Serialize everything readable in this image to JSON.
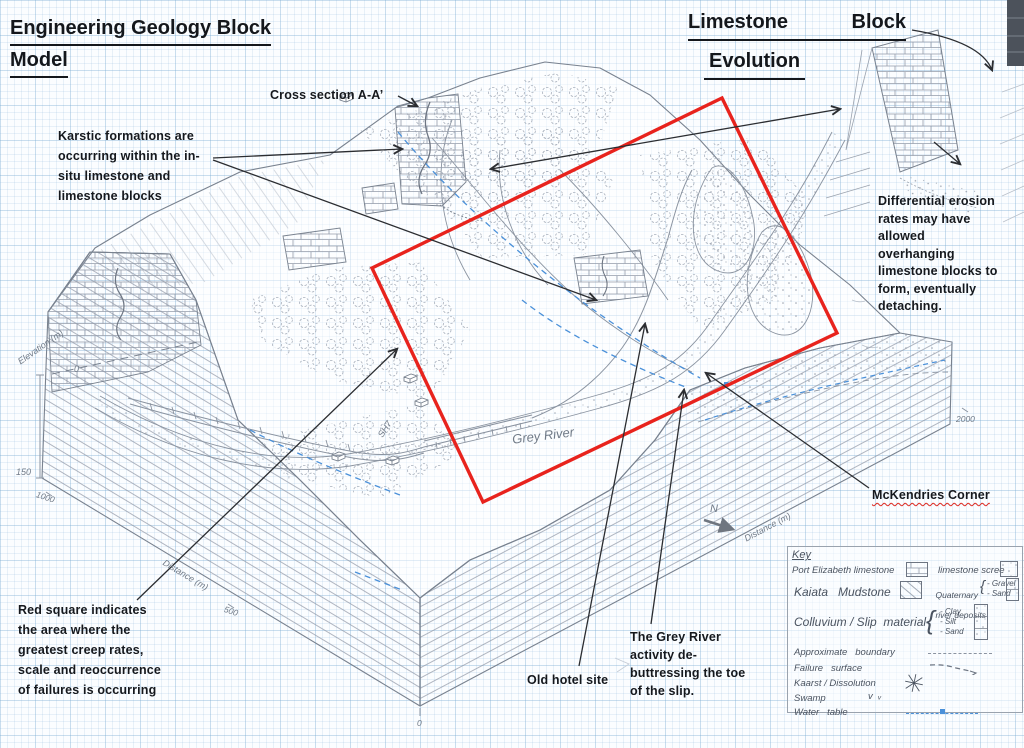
{
  "title": {
    "line1": "Engineering Geology Block",
    "line2": "Model"
  },
  "evolution_title": {
    "word1": "Limestone",
    "word2": "Block",
    "line2": "Evolution"
  },
  "annotations": {
    "cross_section": "Cross section A-A’",
    "karstic": "Karstic formations are\noccurring within the in-\nsitu limestone and\nlimestone blocks",
    "differential_erosion": "Differential erosion\nrates may have\nallowed\noverhanging\nlimestone blocks to\nform, eventually\ndetaching.",
    "red_square": "Red square indicates\nthe area where the\ngreatest creep rates,\nscale and reoccurrence\nof failures is occurring",
    "mckendries": "McKendries Corner",
    "old_hotel": "Old hotel site",
    "grey_river_activity": "The Grey River\nactivity de-\nbuttressing the toe\nof the slip."
  },
  "map_labels": {
    "river": "Grey River",
    "highway": "SH7",
    "north": "N"
  },
  "axes": {
    "elevation_label": "Elevation (m)",
    "elev_top": "0",
    "elev_bottom": "150",
    "dist_left_label": "Distance (m)",
    "dist_left_t1000": "1000",
    "dist_left_t500": "500",
    "dist_front_t0": "0",
    "dist_right_label": "Distance (m)",
    "dist_right_t2000": "2000"
  },
  "legend": {
    "title": "Key",
    "pe_limestone": "Port Elizabeth limestone",
    "limestone_scree": "limestone scree",
    "kaiata": "Kaiata   Mudstone",
    "quaternary_l1": "Quaternary",
    "quaternary_l2": "river deposits",
    "bracket": "{",
    "gravel": "- Gravel",
    "sand": "- Sand",
    "colluvium": "Colluvium / Slip  material",
    "clay": "- Clay",
    "silt": "- Silt",
    "sand2": "- Sand",
    "approx_boundary": "Approximate   boundary",
    "failure_surface": "Failure   surface",
    "kaarst": "Kaarst / Dissolution",
    "swamp": "Swamp",
    "swamp_marks": "v  ᵥ",
    "water_table": "Water   table"
  },
  "colors": {
    "red_square": "#e8231d",
    "water_table_blue": "#4a90d9",
    "pencil_grey": "#8a93a0"
  }
}
